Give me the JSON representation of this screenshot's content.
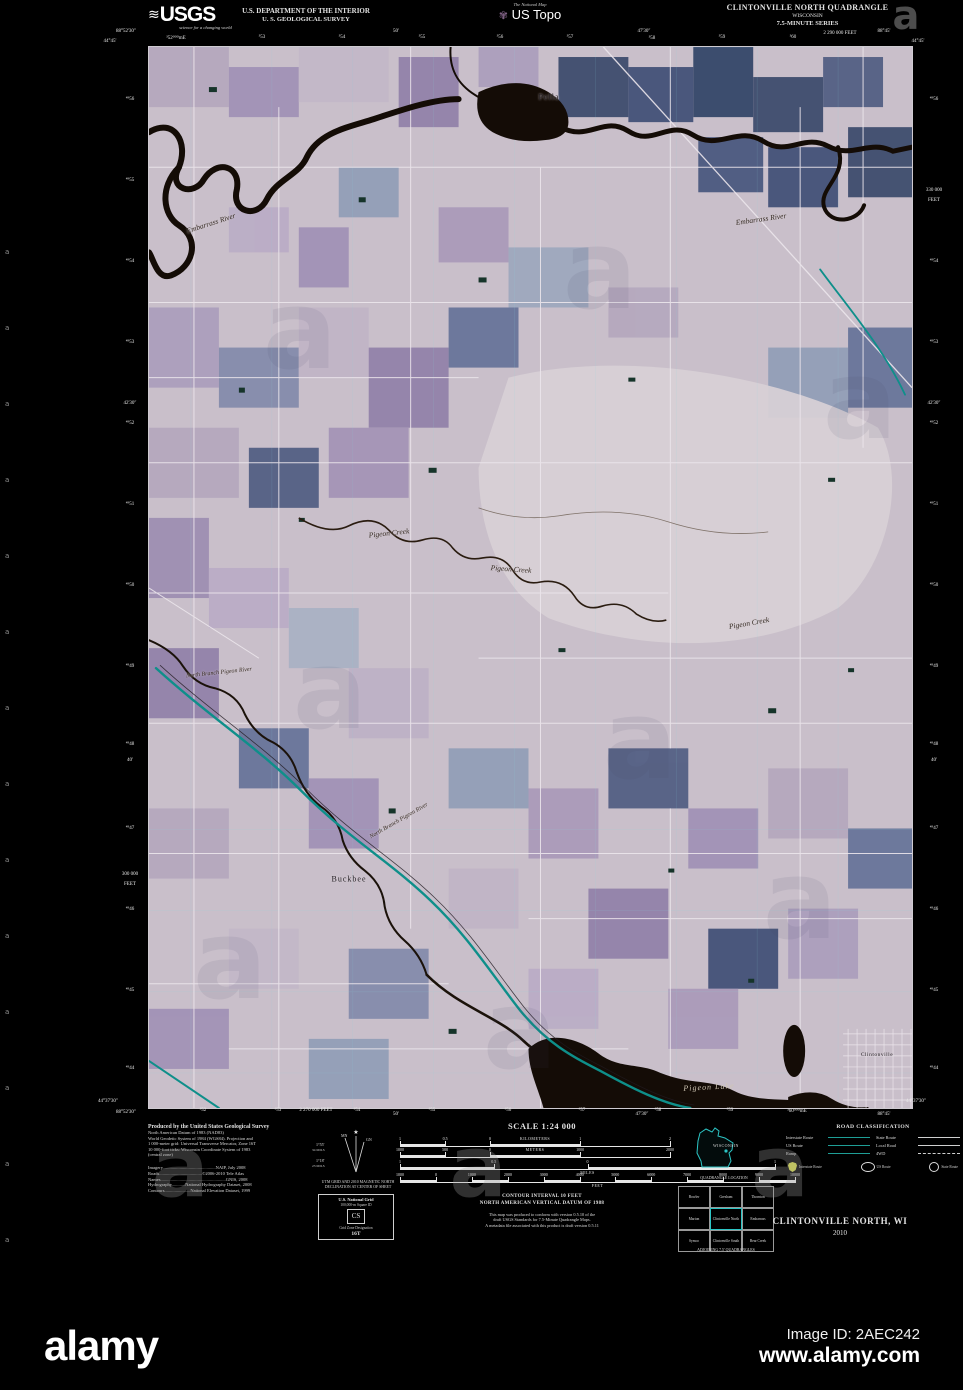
{
  "alamy": {
    "logo_text": "alamy",
    "image_id": "Image ID: 2AEC242",
    "url": "www.alamy.com",
    "watermark_letter": "a",
    "watermarks": {
      "map_positions": [
        [
          300,
          330
        ],
        [
          600,
          270
        ],
        [
          860,
          400
        ],
        [
          330,
          690
        ],
        [
          640,
          740
        ],
        [
          230,
          960
        ],
        [
          520,
          1030
        ],
        [
          800,
          900
        ]
      ],
      "footer_positions": [
        [
          180,
          1168
        ],
        [
          478,
          1168
        ],
        [
          780,
          1168
        ]
      ],
      "corner_position": [
        906,
        16
      ],
      "strip": {
        "x": 5,
        "y_start": 248,
        "step": 76,
        "count": 14
      }
    }
  },
  "header": {
    "usgs_wave": "≋",
    "usgs_text": "USGS",
    "usgs_tagline": "science for a changing world",
    "dept_line1": "U.S. DEPARTMENT OF THE INTERIOR",
    "dept_line2": "U. S. GEOLOGICAL SURVEY",
    "natmap_name": "The National Map",
    "natmap_icon": "✾",
    "natmap_product": "US Topo",
    "quad_title": "CLINTONVILLE NORTH QUADRANGLE",
    "quad_state": "WISCONSIN",
    "quad_series": "7.5-MINUTE SERIES"
  },
  "map": {
    "labels": [
      {
        "t": "Pella",
        "x": 400,
        "y": 50,
        "cls": "town"
      },
      {
        "t": "Embarrass River",
        "x": 62,
        "y": 176,
        "r": -18,
        "cls": "water"
      },
      {
        "t": "Embarrass River",
        "x": 612,
        "y": 172,
        "r": -8,
        "cls": "water"
      },
      {
        "t": "Pigeon Creek",
        "x": 240,
        "y": 486,
        "r": -6,
        "cls": "water"
      },
      {
        "t": "Pigeon Creek",
        "x": 362,
        "y": 522,
        "r": 4,
        "cls": "water"
      },
      {
        "t": "Pigeon Creek",
        "x": 600,
        "y": 576,
        "r": -10,
        "cls": "water"
      },
      {
        "t": "North Branch Pigeon River",
        "x": 70,
        "y": 626,
        "r": -6,
        "cls": "water-sm"
      },
      {
        "t": "North Branch Pigeon River",
        "x": 250,
        "y": 774,
        "r": -30,
        "cls": "water-sm"
      },
      {
        "t": "Buckbee",
        "x": 200,
        "y": 832,
        "cls": "town"
      },
      {
        "t": "Pigeon Lake",
        "x": 560,
        "y": 1040,
        "r": -3,
        "cls": "water-light"
      },
      {
        "t": "Clintonville",
        "x": 728,
        "y": 1008,
        "cls": "town-sm"
      }
    ],
    "edge_ticks": {
      "top": [
        [
          "88°52'30″",
          126,
          29
        ],
        [
          "44°45'",
          110,
          39
        ],
        [
          "³52⁰⁰⁰mE",
          176,
          35
        ],
        [
          "³53",
          262,
          35
        ],
        [
          "³54",
          342,
          35
        ],
        [
          "50'",
          396,
          29
        ],
        [
          "³55",
          422,
          35
        ],
        [
          "³56",
          500,
          35
        ],
        [
          "³57",
          570,
          35
        ],
        [
          "47'30″",
          644,
          29
        ],
        [
          "³58",
          652,
          36
        ],
        [
          "³59",
          722,
          35
        ],
        [
          "³60",
          793,
          35
        ],
        [
          "2 290 000 FEET",
          840,
          31
        ],
        [
          "88°45'",
          884,
          29
        ],
        [
          "44°45'",
          918,
          39
        ]
      ],
      "bottom": [
        [
          "44°37'30″",
          108,
          1099
        ],
        [
          "88°52'30″",
          126,
          1110
        ],
        [
          "³52",
          203,
          1108
        ],
        [
          "³53",
          278,
          1108
        ],
        [
          "2 270 000 FEET",
          316,
          1108
        ],
        [
          "³54",
          357,
          1108
        ],
        [
          "50'",
          396,
          1112
        ],
        [
          "³55",
          432,
          1108
        ],
        [
          "³56",
          508,
          1108
        ],
        [
          "³57",
          582,
          1108
        ],
        [
          "47'30″",
          642,
          1112
        ],
        [
          "³58",
          658,
          1108
        ],
        [
          "³59",
          730,
          1108
        ],
        [
          "³60⁰⁰⁰mE",
          797,
          1108
        ],
        [
          "88°45'",
          884,
          1112
        ],
        [
          "44°37'30″",
          916,
          1099
        ]
      ],
      "left": [
        [
          "⁴⁹56",
          97
        ],
        [
          "⁴⁹55",
          178
        ],
        [
          "⁴⁹54",
          259
        ],
        [
          "⁴⁹53",
          340
        ],
        [
          "42'30″",
          401
        ],
        [
          "⁴⁹52",
          421
        ],
        [
          "⁴⁹51",
          502
        ],
        [
          "⁴⁹50",
          583
        ],
        [
          "⁴⁹49",
          664
        ],
        [
          "⁴⁹48",
          742
        ],
        [
          "40'",
          758
        ],
        [
          "⁴⁹47",
          826
        ],
        [
          "300 000",
          872
        ],
        [
          "FEET",
          882
        ],
        [
          "⁴⁹46",
          907
        ],
        [
          "⁴⁹45",
          988
        ],
        [
          "⁴⁹44",
          1066
        ]
      ],
      "right": [
        [
          "⁴⁹56",
          97
        ],
        [
          "330 000",
          188
        ],
        [
          "FEET",
          198
        ],
        [
          "⁴⁹54",
          259
        ],
        [
          "⁴⁹53",
          340
        ],
        [
          "42'30″",
          401
        ],
        [
          "⁴⁹52",
          421
        ],
        [
          "⁴⁹51",
          502
        ],
        [
          "⁴⁹50",
          583
        ],
        [
          "⁴⁹49",
          664
        ],
        [
          "⁴⁹48",
          742
        ],
        [
          "40'",
          758
        ],
        [
          "⁴⁹47",
          826
        ],
        [
          "⁴⁹46",
          907
        ],
        [
          "⁴⁹45",
          988
        ],
        [
          "⁴⁹44",
          1066
        ]
      ]
    }
  },
  "footer": {
    "credits": {
      "produced": "Produced by the United States Geological Survey",
      "lines": [
        "North American Datum of 1983 (NAD83)",
        "World Geodetic System of 1984 (WGS84).  Projection and",
        "1 000-meter grid: Universal Transverse Mercator, Zone 16T",
        "10 000-foot ticks: Wisconsin Coordinate System of 1983",
        "(central zone)"
      ],
      "sources": [
        "Imagery...............................................NAIP, July 2008",
        "Roads......................................©2006-2010 Tele Atlas",
        "Names..........................................................GNIS, 2008",
        "Hydrography............National Hydrography Dataset, 2008",
        "Contours.......................National Elevation Dataset, 1999"
      ]
    },
    "declination": {
      "star": "★",
      "mn": "MN",
      "gn": "GN",
      "mn_deg": "1°55'",
      "mn_mils": "34 MILS",
      "gn_deg": "1°18'",
      "gn_mils": "23 MILS",
      "caption1": "UTM GRID AND 2010 MAGNETIC NORTH",
      "caption2": "DECLINATION AT CENTER OF SHEET"
    },
    "usng": {
      "title": "U.S. National Grid",
      "subtitle": "100,000-m Square ID",
      "square_id": "CS",
      "gzd_label": "Grid Zone Designation",
      "gzd": "16T"
    },
    "scale": {
      "title": "SCALE 1:24 000",
      "rows": [
        {
          "unit": "KILOMETERS",
          "pos": "above",
          "top": 0,
          "width": 270,
          "labels": [
            [
              "1",
              0
            ],
            [
              "0.5",
              16.7
            ],
            [
              "0",
              33.3
            ],
            [
              "1",
              66.7
            ],
            [
              "2",
              100
            ]
          ]
        },
        {
          "unit": "METERS",
          "pos": "above",
          "top": 11,
          "width": 270,
          "labels": [
            [
              "1000",
              0
            ],
            [
              "500",
              16.7
            ],
            [
              "0",
              33.3
            ],
            [
              "1000",
              66.7
            ],
            [
              "2000",
              100
            ]
          ]
        },
        {
          "unit": "MILES",
          "pos": "below",
          "top": 23,
          "width": 375,
          "labels": [
            [
              "1",
              0
            ],
            [
              "0.5",
              25
            ],
            [
              "0",
              50
            ],
            [
              "1",
              100
            ]
          ]
        },
        {
          "unit": "FEET",
          "pos": "below",
          "top": 36,
          "width": 395,
          "labels": [
            [
              "1000",
              0
            ],
            [
              "0",
              9.1
            ],
            [
              "1000",
              18.2
            ],
            [
              "2000",
              27.3
            ],
            [
              "3000",
              36.4
            ],
            [
              "4000",
              45.5
            ],
            [
              "5000",
              54.5
            ],
            [
              "6000",
              63.6
            ],
            [
              "7000",
              72.7
            ],
            [
              "8000",
              81.8
            ],
            [
              "9000",
              90.9
            ],
            [
              "10000",
              100
            ]
          ]
        }
      ]
    },
    "contour_lines": [
      "CONTOUR INTERVAL 10 FEET",
      "NORTH AMERICAN VERTICAL DATUM OF 1988",
      "",
      "This map was produced to conform with version 0.5.10 of the",
      "draft USGS Standards for 7.5-Minute Quadrangle Maps.",
      "A metadata file associated with this product is draft version 0.5.11"
    ],
    "state_map": {
      "label": "WISCONSIN",
      "caption": "QUADRANGLE LOCATION"
    },
    "adjoining": {
      "cells": [
        "Bowler",
        "Gresham",
        "Thornton",
        "Marion",
        "Clintonville North",
        "Embarrass",
        "Symco",
        "Clintonville South",
        "Bear Creek"
      ],
      "caption": "ADJOINING 7.5' QUADRANGLES"
    },
    "road_class": {
      "title": "ROAD CLASSIFICATION",
      "left_rows": [
        [
          "Interstate Route",
          "teal"
        ],
        [
          "US Route",
          "teal"
        ],
        [
          "Ramp",
          "teal"
        ]
      ],
      "right_rows": [
        [
          "State Route",
          "solid"
        ],
        [
          "Local Road",
          "solid"
        ],
        [
          "4WD",
          "dashed"
        ]
      ],
      "shields": [
        [
          "Interstate Route",
          "interstate"
        ],
        [
          "US Route",
          "oval"
        ],
        [
          "State Route",
          "circle"
        ]
      ]
    },
    "map_name": "CLINTONVILLE NORTH, WI",
    "map_year": "2010"
  },
  "colors": {
    "accent_highway_teal": "#0e8f8a",
    "legend_teal": "#1e9e96",
    "state_outline_cyan": "#2cc5c5",
    "map_base": "#c9bfca",
    "water_inverted": "#140c06",
    "background": "#000000"
  }
}
